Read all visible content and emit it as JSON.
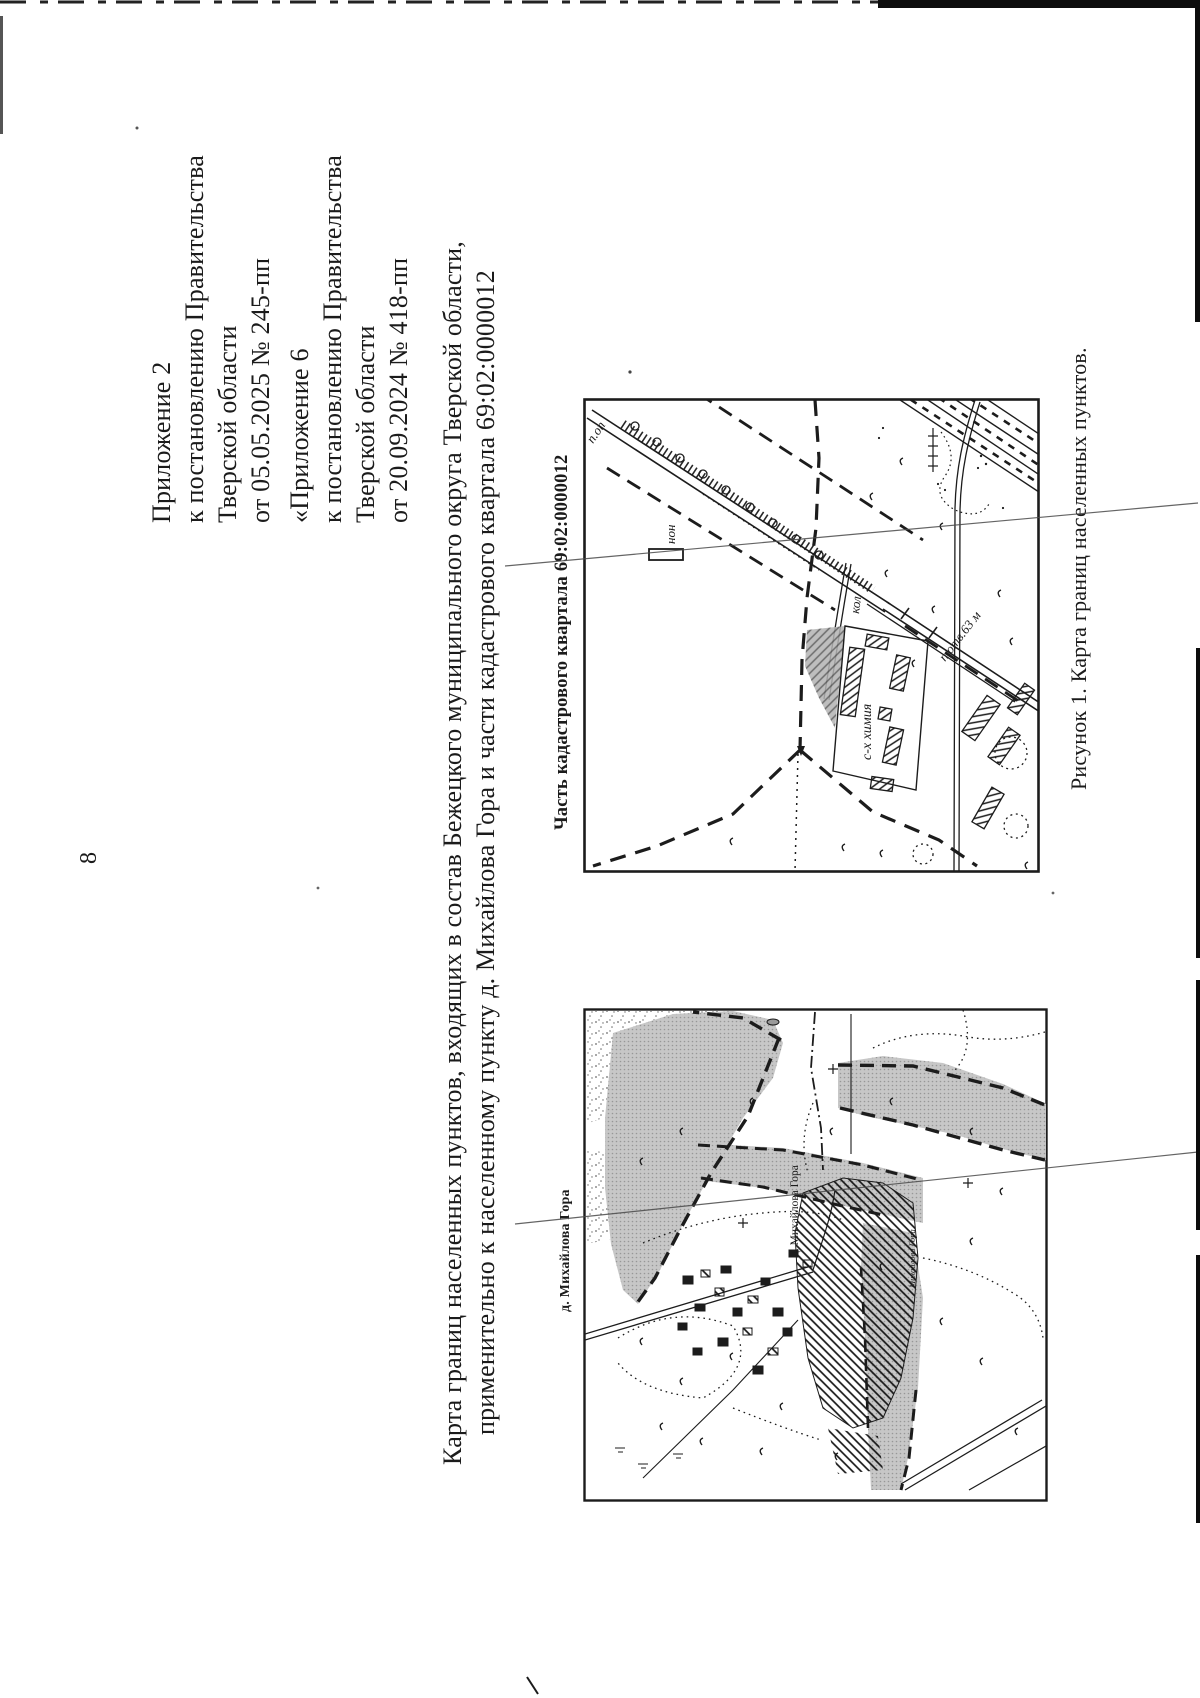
{
  "page_number": "8",
  "appendix_blocks": [
    {
      "lines": [
        "Приложение 2",
        "к постановлению Правительства",
        "Тверской области",
        "от 05.05.2025 № 245-пп"
      ]
    },
    {
      "lines": [
        "«Приложение 6",
        "к постановлению Правительства",
        "Тверской области",
        "от 20.09.2024 № 418-пп"
      ]
    }
  ],
  "title": {
    "line1": "Карта границ населенных пунктов, входящих в состав Бежецкого муниципального округа Тверской области,",
    "line2": "применительно к населенному пункту д. Михайлова Гора и части кадастрового квартала 69:02:0000012"
  },
  "cadastral_map": {
    "label": "Часть кадастрового квартала 69:02:0000012",
    "annotations": {
      "right_of_way_top": "п.оп",
      "building": "нон",
      "road_side": "кол",
      "right_of_way_width": "п.отв.63 м",
      "agro_chemistry": "с-х химия"
    }
  },
  "settlement_map": {
    "label": "д. Михайлова Гора",
    "annotations": {
      "village_name": "д. Михайлова Гора",
      "village_name_small": "Михайлова Гора"
    }
  },
  "figure_caption": "Рисунок 1. Карта границ населенных пунктов.",
  "colors": {
    "ink": "#1b1b1b",
    "gray_fill": "#bdbdbd",
    "page": "#ffffff"
  }
}
